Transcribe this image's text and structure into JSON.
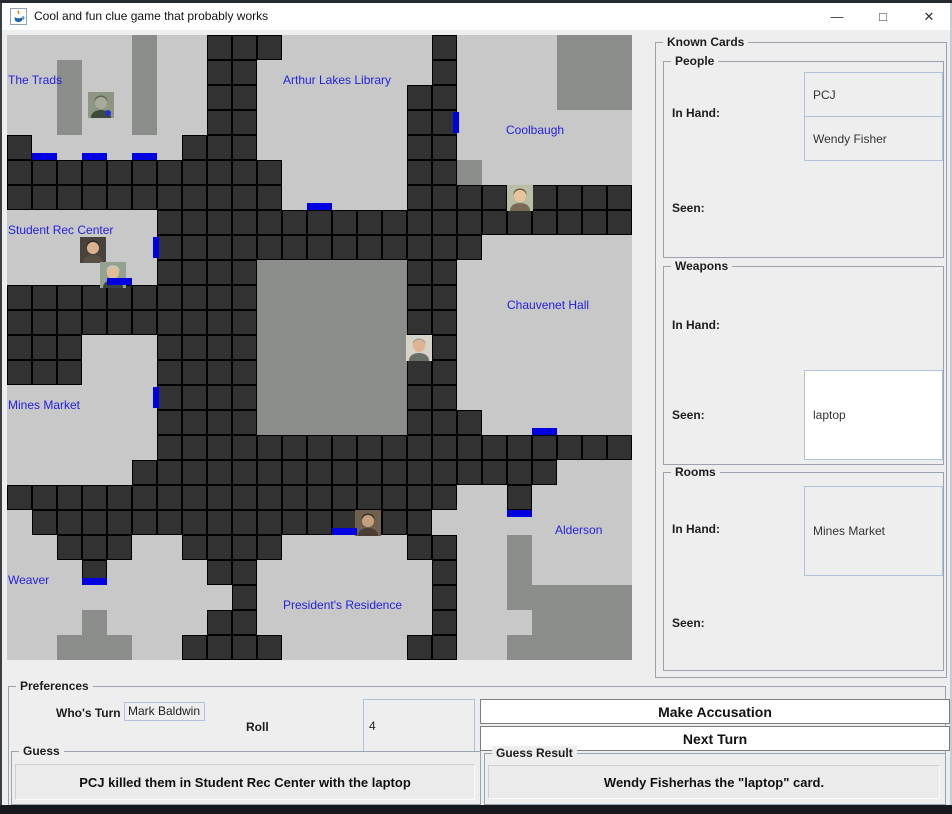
{
  "window": {
    "title": "Cool and fun clue game that probably works",
    "controls": {
      "minimize": "—",
      "maximize": "□",
      "close": "✕"
    },
    "icon": "java-coffee-cup"
  },
  "board": {
    "colors": {
      "floor": "#c8c8c8",
      "corridor": "#323232",
      "block": "#8a8d8a",
      "door": "#0000e0",
      "label": "#2222dd"
    },
    "grid": [
      ".....G..###......#....GGG",
      "..G..G..##.......#....GGG",
      "..G..G..##......##....GGG",
      "..G..G..##......##.......",
      "#......###......##.......",
      "###########.....##G......",
      "###########.....#########",
      "......###################",
      "......#############......",
      "......####GGGGGG##.......",
      "##########GGGGGG##.......",
      "##########GGGGGG##.......",
      "###...####GGGGGG##.......",
      "###...####GGGGGG##.......",
      "......####GGGGGG##.......",
      "......####GGGGGG###......",
      "......###################",
      ".....#################...",
      "##################..#....",
      ".################........",
      "..###..####.....##..G....",
      "...#....##.......#..G....",
      ".........#.......#..GGGGG",
      "...G....##.......#...GGGG",
      "..GGG..####.....##..GGGGG"
    ],
    "doors": [
      {
        "row": 4,
        "col": 1,
        "side": "bottom"
      },
      {
        "row": 4,
        "col": 3,
        "side": "bottom"
      },
      {
        "row": 4,
        "col": 5,
        "side": "bottom"
      },
      {
        "row": 3,
        "col": 17,
        "side": "right"
      },
      {
        "row": 6,
        "col": 12,
        "side": "bottom"
      },
      {
        "row": 8,
        "col": 5,
        "side": "right"
      },
      {
        "row": 9,
        "col": 4,
        "side": "bottom"
      },
      {
        "row": 14,
        "col": 5,
        "side": "right"
      },
      {
        "row": 15,
        "col": 21,
        "side": "bottom"
      },
      {
        "row": 19,
        "col": 20,
        "side": "top"
      },
      {
        "row": 19,
        "col": 13,
        "side": "bottom"
      },
      {
        "row": 21,
        "col": 3,
        "side": "bottom"
      }
    ],
    "rooms": [
      {
        "name": "The Trads",
        "x": 1,
        "y": 38
      },
      {
        "name": "Arthur Lakes Library",
        "x": 276,
        "y": 38
      },
      {
        "name": "Coolbaugh",
        "x": 499,
        "y": 88
      },
      {
        "name": "Student Rec Center",
        "x": 1,
        "y": 188
      },
      {
        "name": "Chauvenet Hall",
        "x": 500,
        "y": 263
      },
      {
        "name": "Mines Market",
        "x": 1,
        "y": 363
      },
      {
        "name": "Alderson",
        "x": 548,
        "y": 488
      },
      {
        "name": "Weaver",
        "x": 1,
        "y": 538
      },
      {
        "name": "President's Residence",
        "x": 276,
        "y": 563
      }
    ],
    "tokens": [
      {
        "x": 81,
        "y": 57,
        "desc": "camouflaged-figure",
        "bg": "#8e9683",
        "skin": "#a8aa9a",
        "hair": "#55604a",
        "body": "#3f4a3a",
        "accent": "#2233cc"
      },
      {
        "x": 500,
        "y": 150,
        "desc": "woman-curly-brown-hair",
        "bg": "#b7bfa4",
        "skin": "#e8c49e",
        "hair": "#6f4b32",
        "body": "#7a6a55"
      },
      {
        "x": 73,
        "y": 202,
        "desc": "man-dark-hair-glasses",
        "bg": "#4a423c",
        "skin": "#d9b391",
        "hair": "#2e2620",
        "body": "#5a4f45"
      },
      {
        "x": 93,
        "y": 227,
        "desc": "man-grey-hair-suit",
        "bg": "#93a38f",
        "skin": "#e3bd96",
        "hair": "#d8d8d4",
        "body": "#3c4148"
      },
      {
        "x": 399,
        "y": 300,
        "desc": "man-smiling",
        "bg": "#d6d4c8",
        "skin": "#e0b492",
        "hair": "#9a938a",
        "body": "#6a6f66"
      },
      {
        "x": 348,
        "y": 475,
        "desc": "man-dark-beard",
        "bg": "#70604e",
        "skin": "#c9a07e",
        "hair": "#33281f",
        "body": "#4a3e33"
      }
    ]
  },
  "known_cards": {
    "title": "Known Cards",
    "sections": [
      {
        "title": "People",
        "in_hand_label": "In Hand:",
        "seen_label": "Seen:",
        "in_hand": [
          "PCJ",
          "Wendy Fisher"
        ],
        "seen": []
      },
      {
        "title": "Weapons",
        "in_hand_label": "In Hand:",
        "seen_label": "Seen:",
        "in_hand": [],
        "seen": [
          "laptop"
        ]
      },
      {
        "title": "Rooms",
        "in_hand_label": "In Hand:",
        "seen_label": "Seen:",
        "in_hand": [
          "Mines Market"
        ],
        "seen": []
      }
    ]
  },
  "preferences": {
    "title": "Preferences",
    "whos_turn_label": "Who's Turn",
    "whos_turn_value": "Mark Baldwin",
    "roll_label": "Roll",
    "roll_value": "4",
    "accusation_button": "Make Accusation",
    "next_turn_button": "Next Turn",
    "guess": {
      "title": "Guess",
      "text": "PCJ killed them in Student Rec Center with the laptop"
    },
    "guess_result": {
      "title": "Guess Result",
      "text": "Wendy Fisherhas the \"laptop\" card."
    }
  }
}
